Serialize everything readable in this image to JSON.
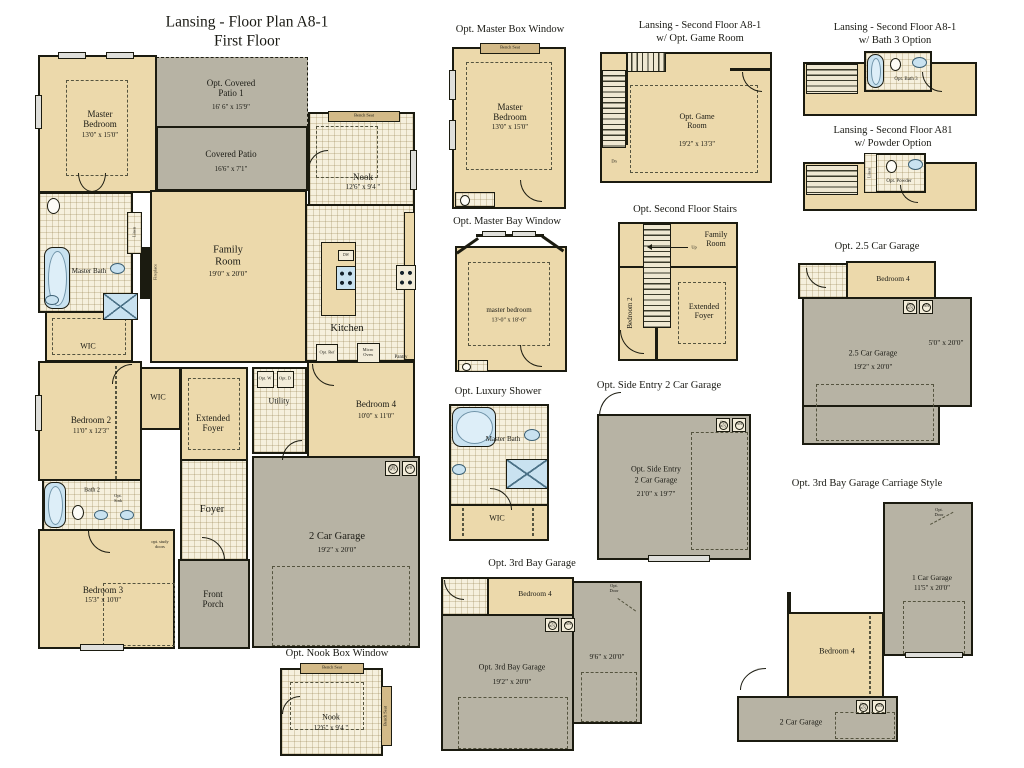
{
  "colors": {
    "wall": "#1b1b10",
    "room_cream": "#ecd9ab",
    "patio_gray": "#b7b3a4",
    "tile": "#f6f0dd",
    "fixture_blue": "#c9e2f0",
    "bench_tan": "#d3ba88"
  },
  "labels": {
    "bench": "Bench Seat",
    "ws": "Opt W/S",
    "wh": "WH",
    "linen": "Linen",
    "dw": "DW"
  },
  "main": {
    "title1": "Lansing - Floor Plan A8-1",
    "title2": "First Floor",
    "master_bedroom": {
      "name": "Master Bedroom",
      "dims": "13'0\" x 15'0\""
    },
    "opt_patio": {
      "name": "Opt. Covered Patio 1",
      "dims": "16' 6\" x 15'9\""
    },
    "covered_patio": {
      "name": "Covered Patio",
      "dims": "16'6\" x 7'1\""
    },
    "nook": {
      "name": "Nook",
      "dims": "12'6\" x 9'4 \""
    },
    "family": {
      "name": "Family Room",
      "dims": "19'0\" x 20'0\""
    },
    "kitchen": {
      "name": "Kitchen"
    },
    "master_bath": {
      "name": "Master Bath"
    },
    "wic": "WIC",
    "bedroom2": {
      "name": "Bedroom 2",
      "dims": "11'0\" x 12'3\""
    },
    "bath2": {
      "name": "Bath 2",
      "opt_sink": "Opt. Sink"
    },
    "ext_foyer": {
      "name": "Extended Foyer"
    },
    "utility": {
      "name": "Utility",
      "opt_w": "Opt. W",
      "opt_d": "Opt. D"
    },
    "bedroom4": {
      "name": "Bedroom 4",
      "dims": "10'0\" x 11'0\""
    },
    "foyer": {
      "name": "Foyer"
    },
    "bedroom3": {
      "name": "Bedroom 3",
      "dims": "15'3\" x 10'0\""
    },
    "porch": {
      "name": "Front Porch"
    },
    "garage": {
      "name": "2 Car Garage",
      "dims": "19'2\" x 20'0\""
    },
    "fireplace": "Fireplace",
    "opt_ref": "Opt. Ref",
    "micro": "Micro Oven",
    "pantry": "Pantry",
    "study": "opt. study doors"
  },
  "master_box": {
    "title": "Opt. Master Box Window",
    "name": "Master Bedroom",
    "dims": "13'0\" x 15'0\""
  },
  "game": {
    "t1": "Lansing - Second Floor A8-1",
    "t2": "w/ Opt. Game Room",
    "name": "Opt. Game Room",
    "dims": "19'2\" x 13'3\"",
    "dn": "Dn"
  },
  "bath3": {
    "t1": "Lansing - Second Floor A8-1",
    "t2": "w/ Bath 3 Option",
    "name": "Opt. Bath 3"
  },
  "powder": {
    "t1": "Lansing - Second Floor A81",
    "t2": "w/ Powder Option",
    "name": "Opt. Powder"
  },
  "bay_window": {
    "title": "Opt. Master Bay Window",
    "name": "master bedroom",
    "dims": "13'-0\" x 18'-0\""
  },
  "stairs2": {
    "title": "Opt. Second Floor Stairs",
    "family": "Family Room",
    "bedroom2": "Bedroom 2",
    "foyer": "Extended Foyer",
    "up": "Up"
  },
  "garage25": {
    "title": "Opt. 2.5 Car Garage",
    "bedroom4": "Bedroom 4",
    "name": "2.5 Car Garage",
    "dims": "19'2\" x 20'0\"",
    "dims2": "5'0\" x 20'0\""
  },
  "shower": {
    "title": "Opt. Luxury Shower",
    "bath": "Master Bath",
    "wic": "WIC"
  },
  "side_entry": {
    "title": "Opt. Side Entry 2 Car Garage",
    "line1": "Opt. Side Entry",
    "line2": "2 Car Garage",
    "dims": "21'0\" x 19'7\""
  },
  "bay3": {
    "title": "Opt. 3rd Bay Garage",
    "bedroom4": "Bedroom 4",
    "name": "Opt. 3rd Bay Garage",
    "dims": "19'2\" x 20'0\"",
    "dims2": "9'6\" x 20'0\"",
    "door": "Opt. Door"
  },
  "carriage": {
    "title": "Opt. 3rd Bay Garage Carriage Style",
    "g1": "1 Car Garage",
    "g1dims": "11'5\" x 20'0\"",
    "bedroom4": "Bedroom 4",
    "g2": "2 Car Garage",
    "door": "Opt. Door"
  },
  "nook_box": {
    "title": "Opt. Nook Box Window",
    "name": "Nook",
    "dims": "12'6\" x 9'4 \""
  }
}
